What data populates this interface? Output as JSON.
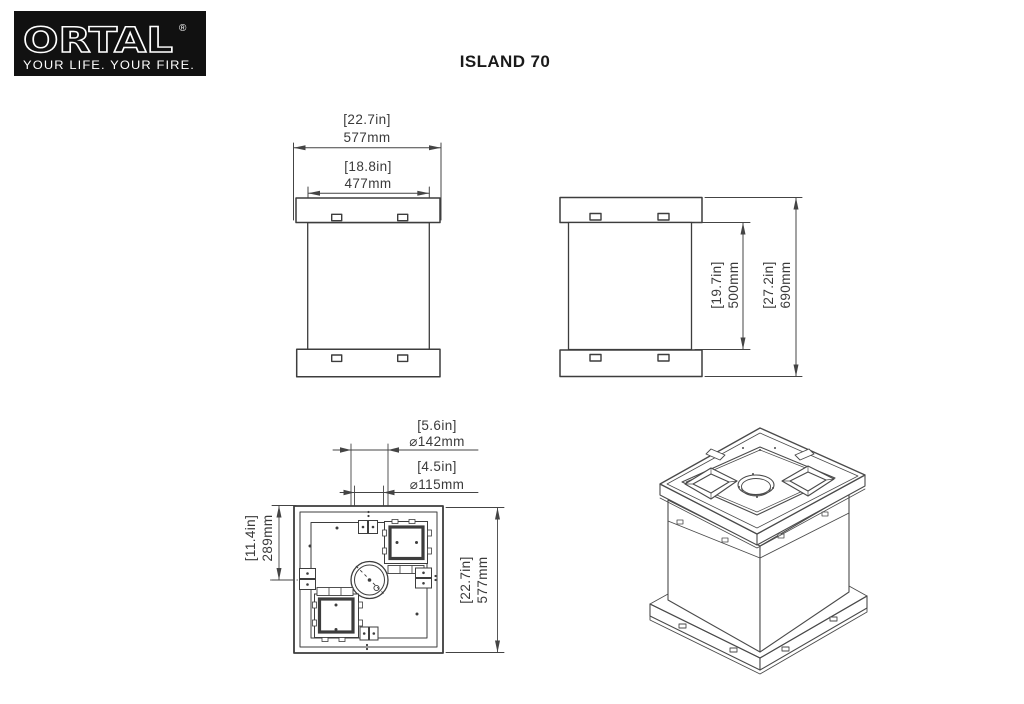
{
  "logo": {
    "brand": "ORTAL",
    "registered": "®",
    "tagline": "YOUR LIFE. YOUR FIRE.",
    "bg_color": "#111111",
    "fg_color": "#ffffff"
  },
  "title": "ISLAND 70",
  "colors": {
    "line": "#444444",
    "text": "#3a3a3a"
  },
  "front_view": {
    "width_overall_in": "[22.7in]",
    "width_overall_mm": "577mm",
    "width_body_in": "[18.8in]",
    "width_body_mm": "477mm"
  },
  "side_view": {
    "height_body_in": "[19.7in]",
    "height_body_mm": "500mm",
    "height_overall_in": "[27.2in]",
    "height_overall_mm": "690mm"
  },
  "plan_view": {
    "flue_outer_in": "[5.6in]",
    "flue_outer_mm": "⌀142mm",
    "flue_inner_in": "[4.5in]",
    "flue_inner_mm": "⌀115mm",
    "center_offset_in": "[11.4in]",
    "center_offset_mm": "289mm",
    "width_in": "[22.7in]",
    "width_mm": "577mm"
  }
}
